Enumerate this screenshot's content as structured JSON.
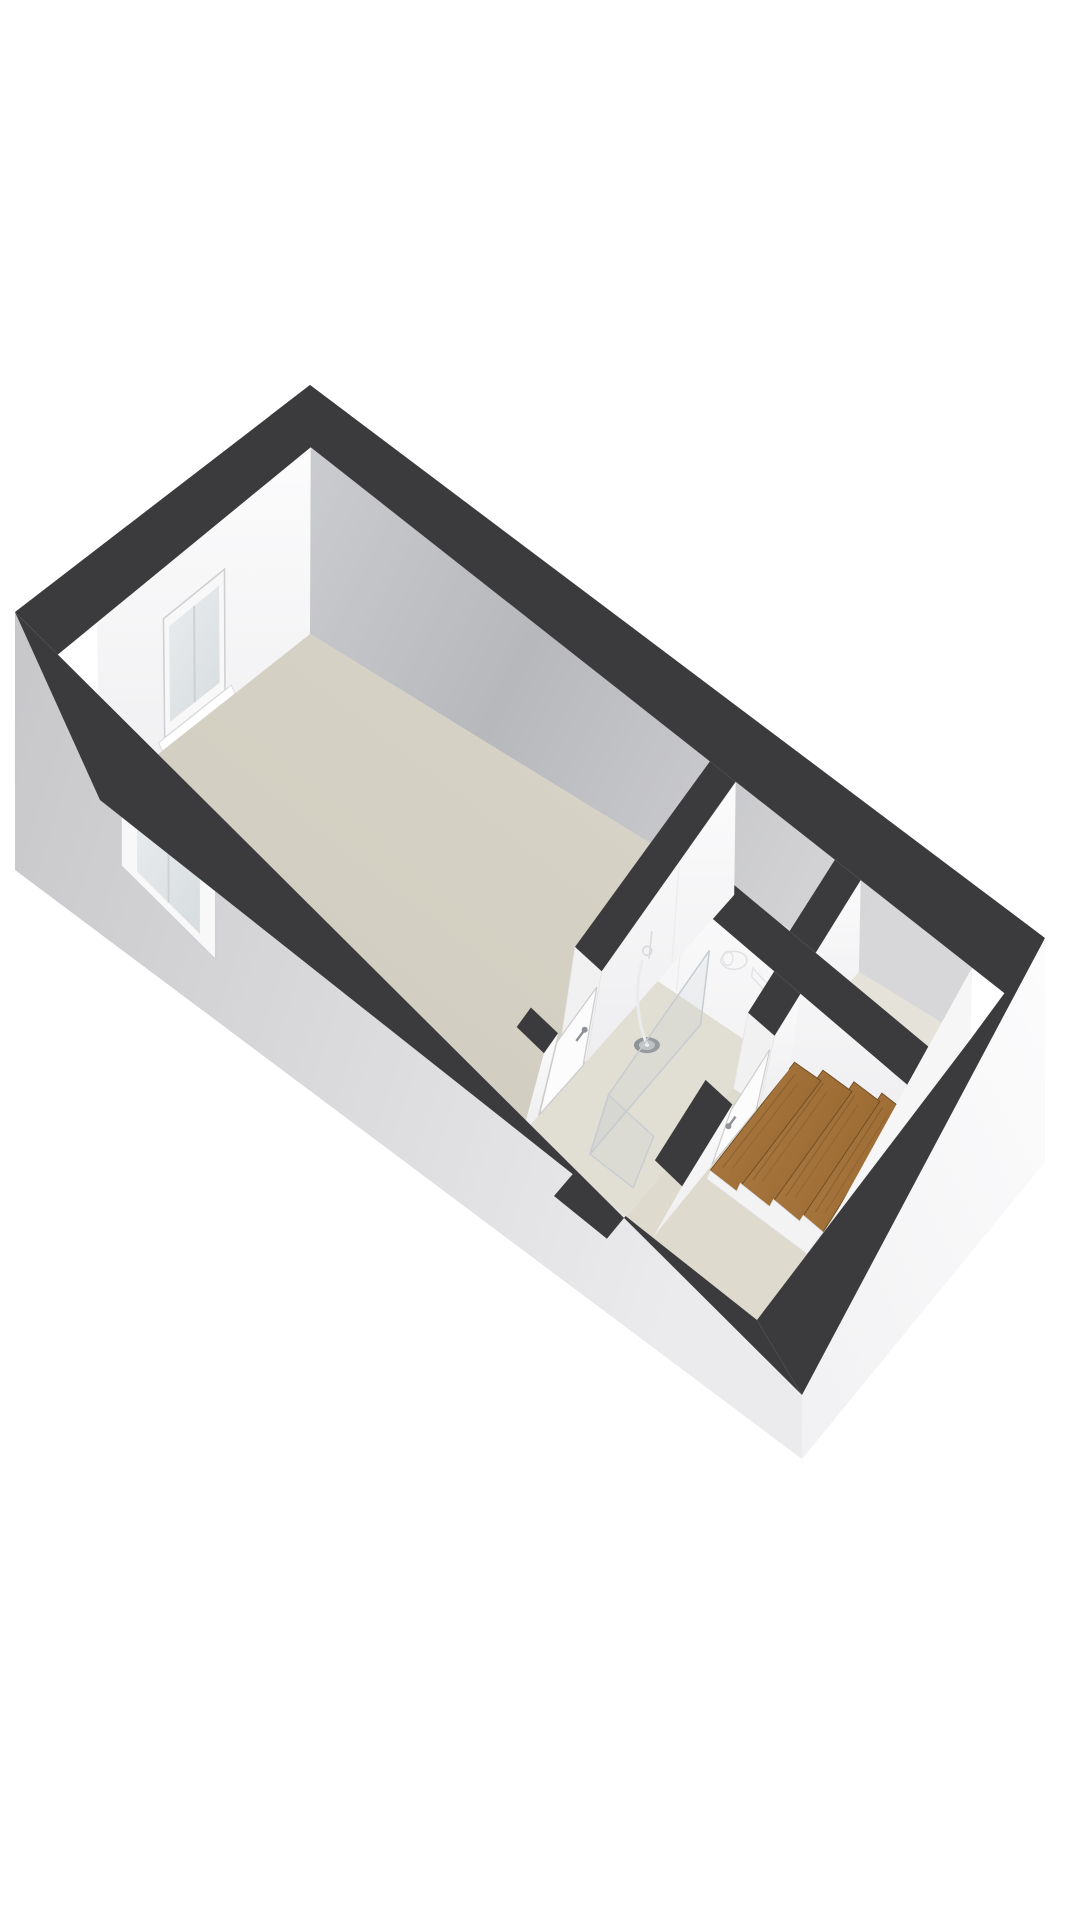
{
  "scene": {
    "title": "3D floor plan - studio apartment upper floor with bathroom and stairs",
    "background": "#ffffff"
  },
  "colors": {
    "wall_top": "#3b3b3d",
    "left_face_hi": "#fcfcfd",
    "left_face_lo": "#efeff1",
    "gray_face_a": "#cbccd0",
    "gray_face_b": "#b7b8bc",
    "gray_face_c": "#d7d7d9",
    "ext_left_dark": "#c7c7ca",
    "ext_left_light": "#ebebed",
    "ext_right_hi": "#fcfcfd",
    "ext_right_lo": "#f1f1f3",
    "floor_main_hi": "#dad6ca",
    "floor_main_lo": "#cdc9bb",
    "floor_bath": "#e1ded4",
    "floor_hall": "#dedacd",
    "floor_closet": "#e4e2d9",
    "partition_hi": "#fbfbfc",
    "partition_lo": "#eeeef0",
    "jamb": "#f1f1f2",
    "stair_wood_hi": "#b17f47",
    "stair_wood_lo": "#96672f",
    "stair_riser": "#7c5425",
    "stair_edge": "#6e4b21",
    "stair_stringer": "#f3f3f4",
    "glass_fill": "rgba(190,200,205,0.16)",
    "glass_edge": "#c6ccd0",
    "fixture_outline": "#e2e3e5",
    "drain_dark": "#8f9296",
    "drain_light": "#bfc1c4",
    "window_frame": "#f8f8f9",
    "window_frame_edge": "#cfd0d3",
    "window_glass_hi": "#eaedef",
    "window_glass_lo": "#d9dee1",
    "door_face": "#fcfcfd",
    "door_outline": "#cccccd",
    "handle": "#8e9297",
    "recess_back": "#e9e9e7",
    "step_light": "#f2f2f0",
    "step_dark": "#e6e6e3",
    "seam": "#ededef"
  },
  "structure": {
    "rooms": [
      {
        "name": "main-room",
        "floor": "beige"
      },
      {
        "name": "bathroom",
        "fixtures": [
          "shower-glass-screen",
          "floor-drain",
          "toilet-outline",
          "sink-outline"
        ]
      },
      {
        "name": "entry-hall",
        "features": [
          "entry-recess-with-steps"
        ]
      },
      {
        "name": "closet-left"
      },
      {
        "name": "closet-right"
      }
    ],
    "stairs": {
      "material": "wood",
      "visible_treads": 4
    },
    "windows": [
      {
        "name": "window-left-wall-interior"
      },
      {
        "name": "window-bottom-wall-exterior"
      }
    ],
    "doors": [
      {
        "name": "bathroom-door-west",
        "handle": true
      },
      {
        "name": "bathroom-door-east",
        "handle": true
      },
      {
        "name": "entry-door-recess",
        "handle": false
      }
    ]
  }
}
